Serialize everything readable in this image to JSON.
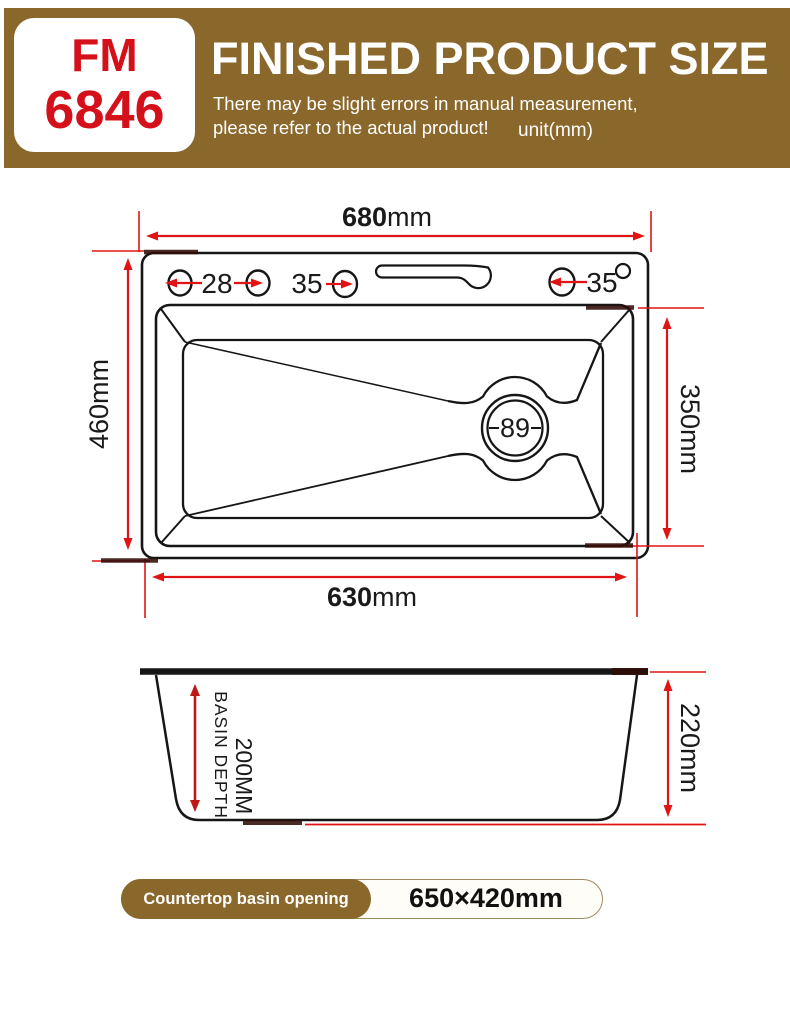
{
  "header": {
    "model_line1": "FM",
    "model_line2": "6846",
    "title": "FINISHED PRODUCT SIZE",
    "subtitle_line1": "There may be slight errors in manual measurement,",
    "subtitle_line2": "please refer to the actual product!",
    "unit_note": "unit(mm)"
  },
  "top_view": {
    "width_top": {
      "number": "680",
      "unit": "mm"
    },
    "width_bottom": {
      "number": "630",
      "unit": "mm"
    },
    "height_left": "460mm",
    "height_right": "350mm",
    "hole_gap_left": "28",
    "hole_gap_mid": "35",
    "hole_gap_right": "35",
    "drain_diameter": "89"
  },
  "side_view": {
    "basin_depth_label": "BASIN DEPTH",
    "basin_depth_value": "200MM",
    "overall_height": "220mm"
  },
  "footer": {
    "label": "Countertop basin opening",
    "value": "650×420mm"
  },
  "colors": {
    "banner_bg": "#8a672b",
    "model_red": "#d4101a",
    "dimension_red": "#e01414",
    "line_black": "#161616",
    "dark_patch": "#300d08",
    "pill_border": "#9d8a60"
  }
}
